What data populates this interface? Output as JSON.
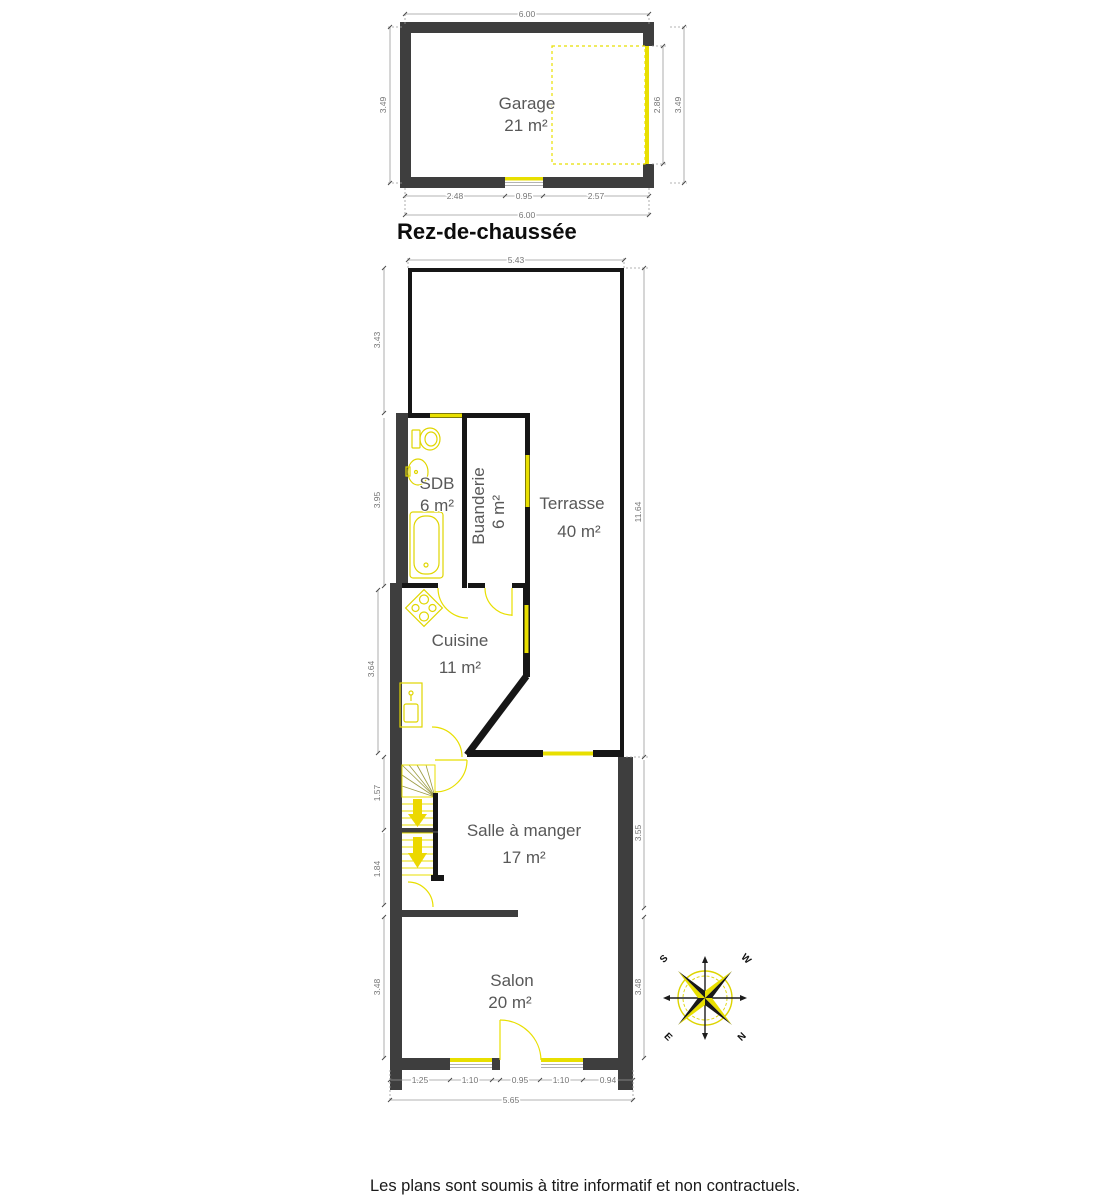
{
  "title": "Rez-de-chaussée",
  "disclaimer": "Les plans sont soumis à titre informatif et non contractuels.",
  "colors": {
    "wall_dark": "#3e3e3e",
    "wall_black": "#161616",
    "accent_yellow": "#e8df00",
    "dim_gray": "#9a9a9a",
    "label_gray": "#585858"
  },
  "garage": {
    "name": "Garage",
    "area": "21 m²",
    "dims": {
      "top": "6.00",
      "left": "3.49",
      "right_inner": "2.86",
      "right_outer": "3.49",
      "bottom": [
        "2.48",
        "0.95",
        "2.57"
      ],
      "bottom_total": "6.00"
    }
  },
  "floor": {
    "rooms": [
      {
        "name": "SDB",
        "area": "6 m²"
      },
      {
        "name": "Buanderie",
        "area": "6 m²"
      },
      {
        "name": "Terrasse",
        "area": "40 m²"
      },
      {
        "name": "Cuisine",
        "area": "11 m²"
      },
      {
        "name": "Salle à manger",
        "area": "17 m²"
      },
      {
        "name": "Salon",
        "area": "20 m²"
      }
    ],
    "dims": {
      "top": "5.43",
      "left": [
        "3.43",
        "3.95",
        "3.64",
        "1.57",
        "1.84",
        "3.48"
      ],
      "right": [
        "11.64",
        "3.55",
        "3.48"
      ],
      "bottom": [
        "1.25",
        "1.10",
        "0.95",
        "1.10",
        "0.94"
      ],
      "bottom_total": "5.65"
    }
  },
  "compass": {
    "n": "N",
    "s": "S",
    "e": "E",
    "w": "W"
  }
}
